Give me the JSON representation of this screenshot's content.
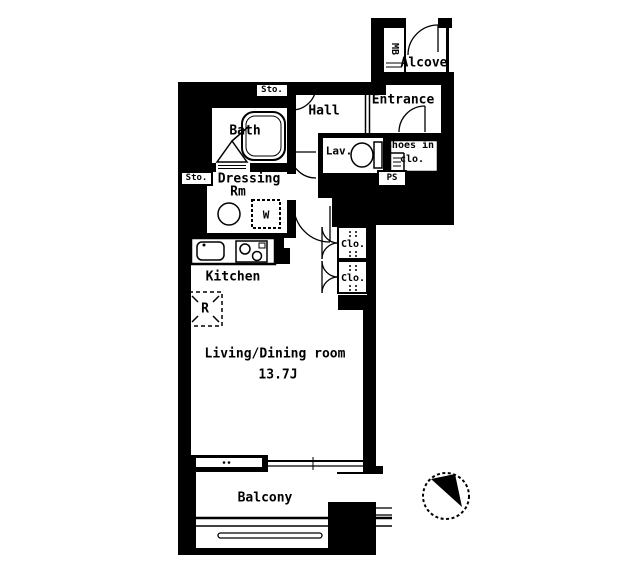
{
  "colors": {
    "wall": "#000000",
    "floor": "#ffffff"
  },
  "rooms": {
    "hall": "Hall",
    "entrance": "Entrance",
    "alcove": "Alcove",
    "bath": "Bath",
    "lavatory": "Lav.",
    "shoes_closet_line1": "Shoes in",
    "shoes_closet_line2": "clo.",
    "dressing_line1": "Dressing",
    "dressing_line2": "Rm",
    "kitchen": "Kitchen",
    "living_dining": "Living/Dining room",
    "living_dining_size": "13.7J",
    "balcony": "Balcony"
  },
  "fixtures": {
    "storage_upper": "Sto.",
    "storage_lower": "Sto.",
    "meter_box": "MB",
    "pipe_shaft": "PS",
    "washer": "W",
    "refrigerator": "R",
    "closet_upper": "Clo.",
    "closet_lower": "Clo."
  }
}
